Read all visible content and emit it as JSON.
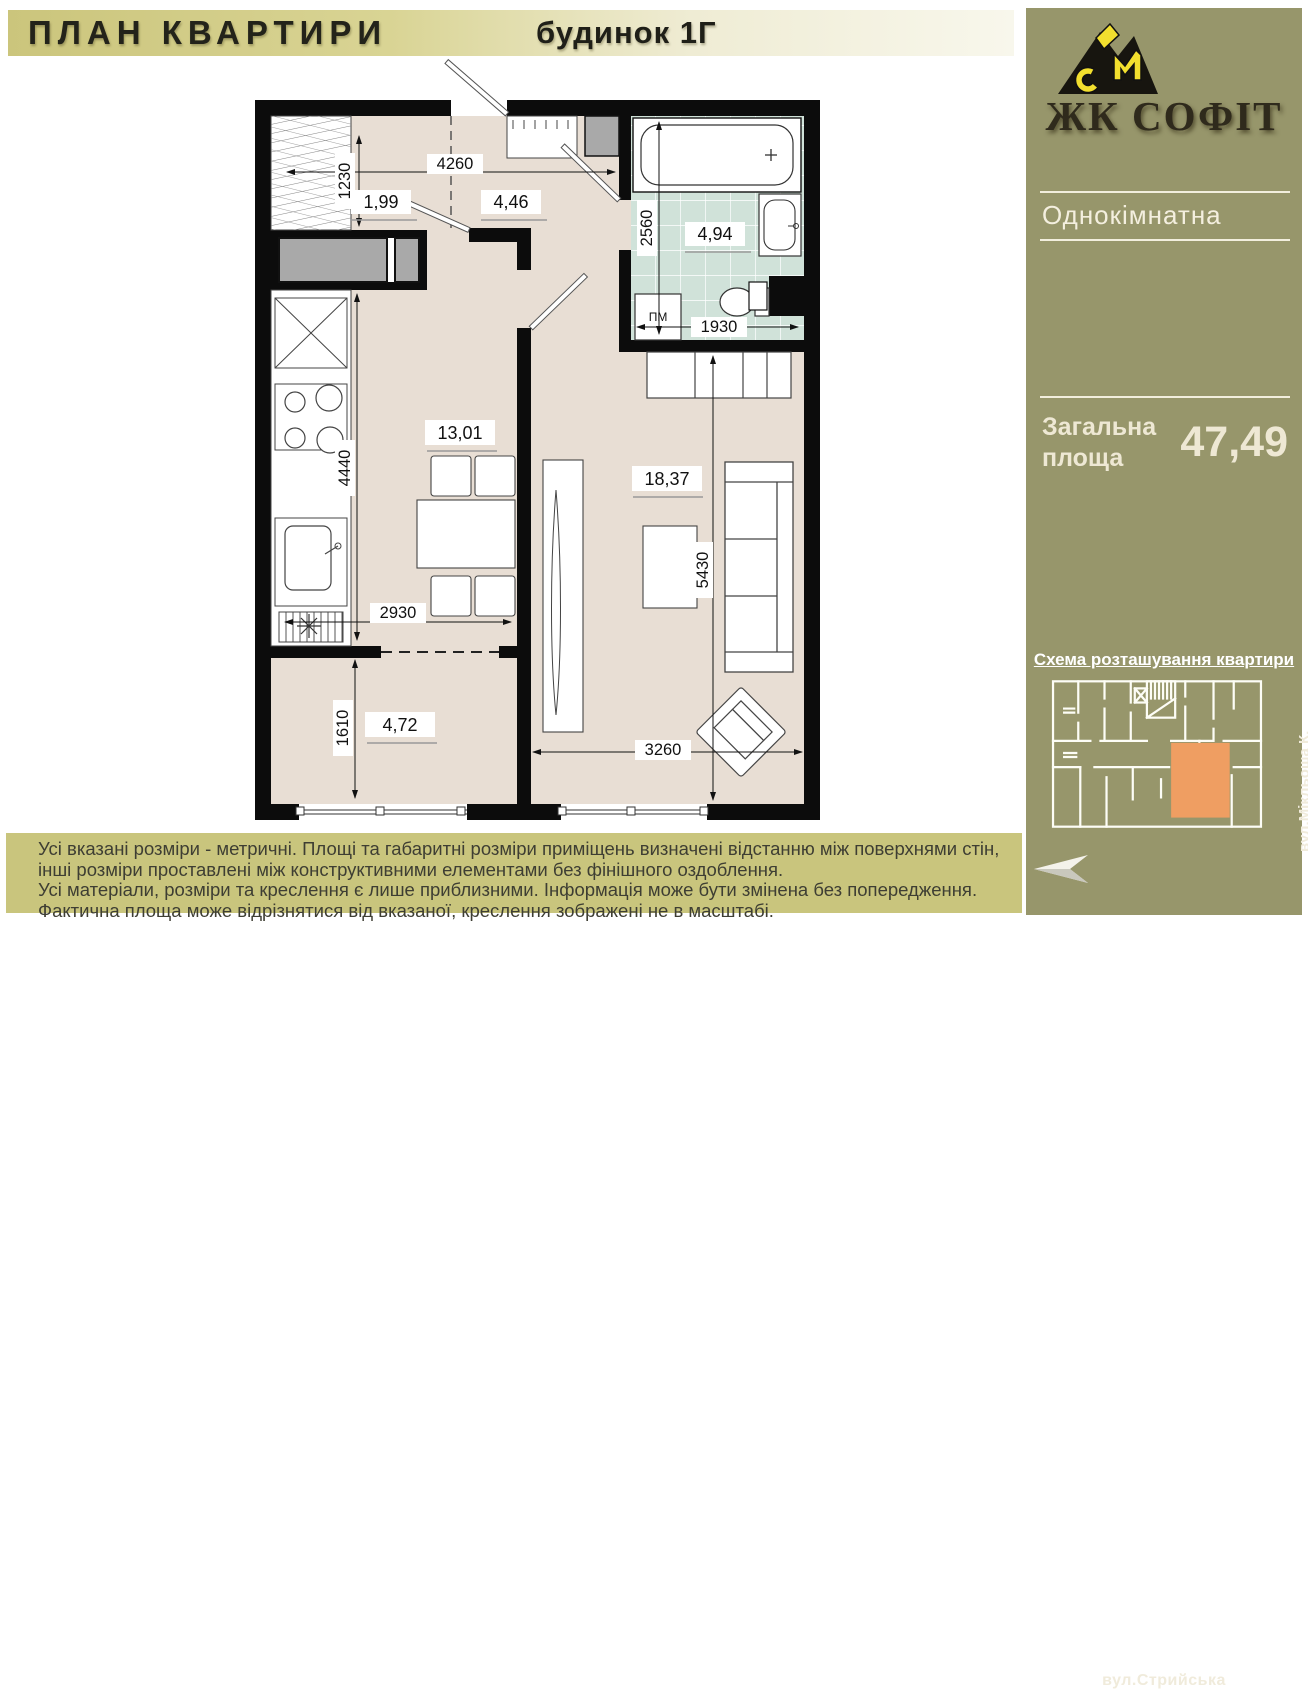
{
  "header": {
    "title": "ПЛАН КВАРТИРИ",
    "building": "будинок 1Г"
  },
  "sidebar": {
    "brand": "ЖК СОФІТ",
    "apartment_type": "Однокімнатна",
    "total_area_label_line1": "Загальна",
    "total_area_label_line2": "площа",
    "total_area_value": "47,49",
    "scheme_title": "Схема розташування квартири",
    "street_side": "вул.Мікльоша К.",
    "street_bottom": "вул.Стрийська"
  },
  "plan": {
    "rooms": [
      {
        "name": "wardrobe",
        "area": "1,99"
      },
      {
        "name": "hallway",
        "area": "4,46"
      },
      {
        "name": "bathroom",
        "area": "4,94"
      },
      {
        "name": "kitchen",
        "area": "13,01"
      },
      {
        "name": "living-room",
        "area": "18,37"
      },
      {
        "name": "balcony",
        "area": "4,72"
      }
    ],
    "dimensions": [
      {
        "value": "4260"
      },
      {
        "value": "1230"
      },
      {
        "value": "2560"
      },
      {
        "value": "1930"
      },
      {
        "value": "4440"
      },
      {
        "value": "2930"
      },
      {
        "value": "1610"
      },
      {
        "value": "5430"
      },
      {
        "value": "3260"
      }
    ],
    "washing_machine_label": "ПМ"
  },
  "footer": {
    "lines": [
      "Усі вказані розміри - метричні. Площі та габаритні розміри приміщень визначені відстанню між  поверхнями стін,",
      "інші розміри проставлені між конструктивними елементами без фінішного оздоблення.",
      "Усі матеріали, розміри та креслення є лише приблизними. Інформація може бути змінена без попередження.",
      "Фактична площа може відрізнятися від вказаної, креслення зображені не в масштабі."
    ]
  },
  "colors": {
    "sidebar": "#97966b",
    "footer_band": "#c9c57d",
    "highlight_orange": "#ef9e62",
    "floor": "#e8ded4",
    "bath_tile": "#d0e2d9",
    "logo_yellow": "#f2df2e"
  }
}
